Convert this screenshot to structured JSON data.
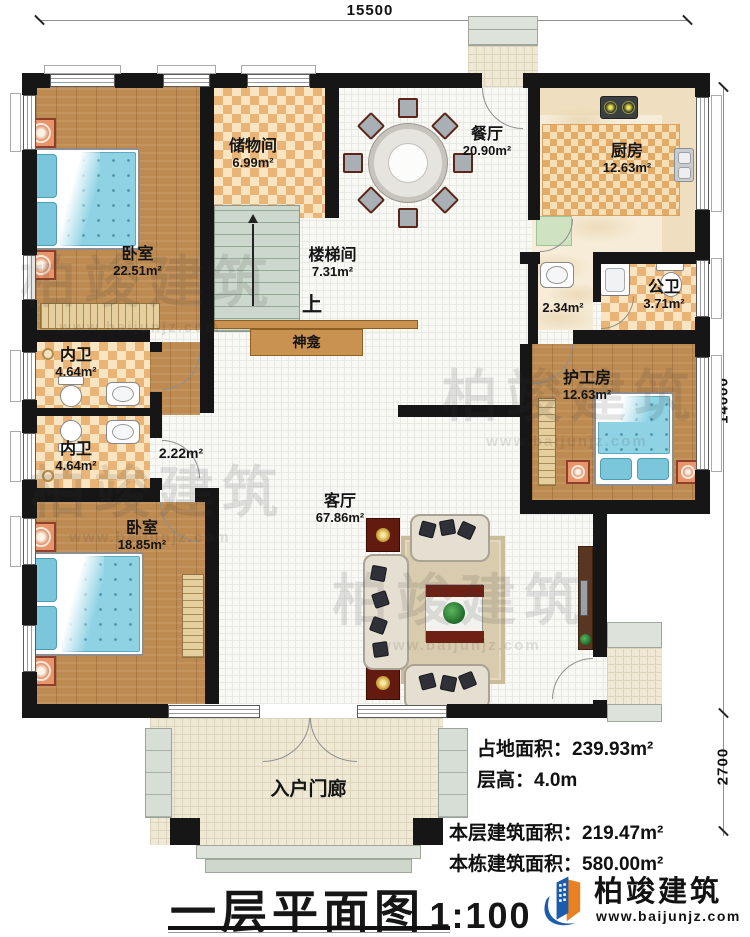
{
  "dimensions": {
    "top": "15500",
    "right_upper": "14000",
    "right_lower": "2700"
  },
  "rooms": {
    "bedroom1": {
      "name": "卧室",
      "area": "22.51m²"
    },
    "storage": {
      "name": "储物间",
      "area": "6.99m²"
    },
    "stairwell": {
      "name": "楼梯间",
      "area": "7.31m²",
      "up_label": "上"
    },
    "dining": {
      "name": "餐厅",
      "area": "20.90m²"
    },
    "kitchen": {
      "name": "厨房",
      "area": "12.63m²"
    },
    "laundry": {
      "area": "2.34m²"
    },
    "public_bath": {
      "name": "公卫",
      "area": "3.71m²"
    },
    "bath1": {
      "name": "内卫",
      "area": "4.64m²"
    },
    "bath2": {
      "name": "内卫",
      "area": "4.64m²"
    },
    "hallway": {
      "area": "2.22m²"
    },
    "shrine": {
      "name": "神龛"
    },
    "living": {
      "name": "客厅",
      "area": "67.86m²"
    },
    "bedroom2": {
      "name": "卧室",
      "area": "18.85m²"
    },
    "caregiver": {
      "name": "护工房",
      "area": "12.63m²"
    },
    "porch": {
      "name": "入户门廊"
    }
  },
  "stats": {
    "land": {
      "label": "占地面积：",
      "value": "239.93m²"
    },
    "height": {
      "label": "层高：",
      "value": "4.0m"
    },
    "floor": {
      "label": "本层建筑面积：",
      "value": "219.47m²"
    },
    "building": {
      "label": "本栋建筑面积：",
      "value": "580.00m²"
    }
  },
  "titleblock": {
    "title": "一层平面图",
    "scale": "1:100"
  },
  "brand": {
    "name": "柏竣建筑",
    "website": "www.baijunjz.com"
  },
  "watermark": {
    "name": "柏竣建筑",
    "website": "www.baijunjz.com"
  }
}
